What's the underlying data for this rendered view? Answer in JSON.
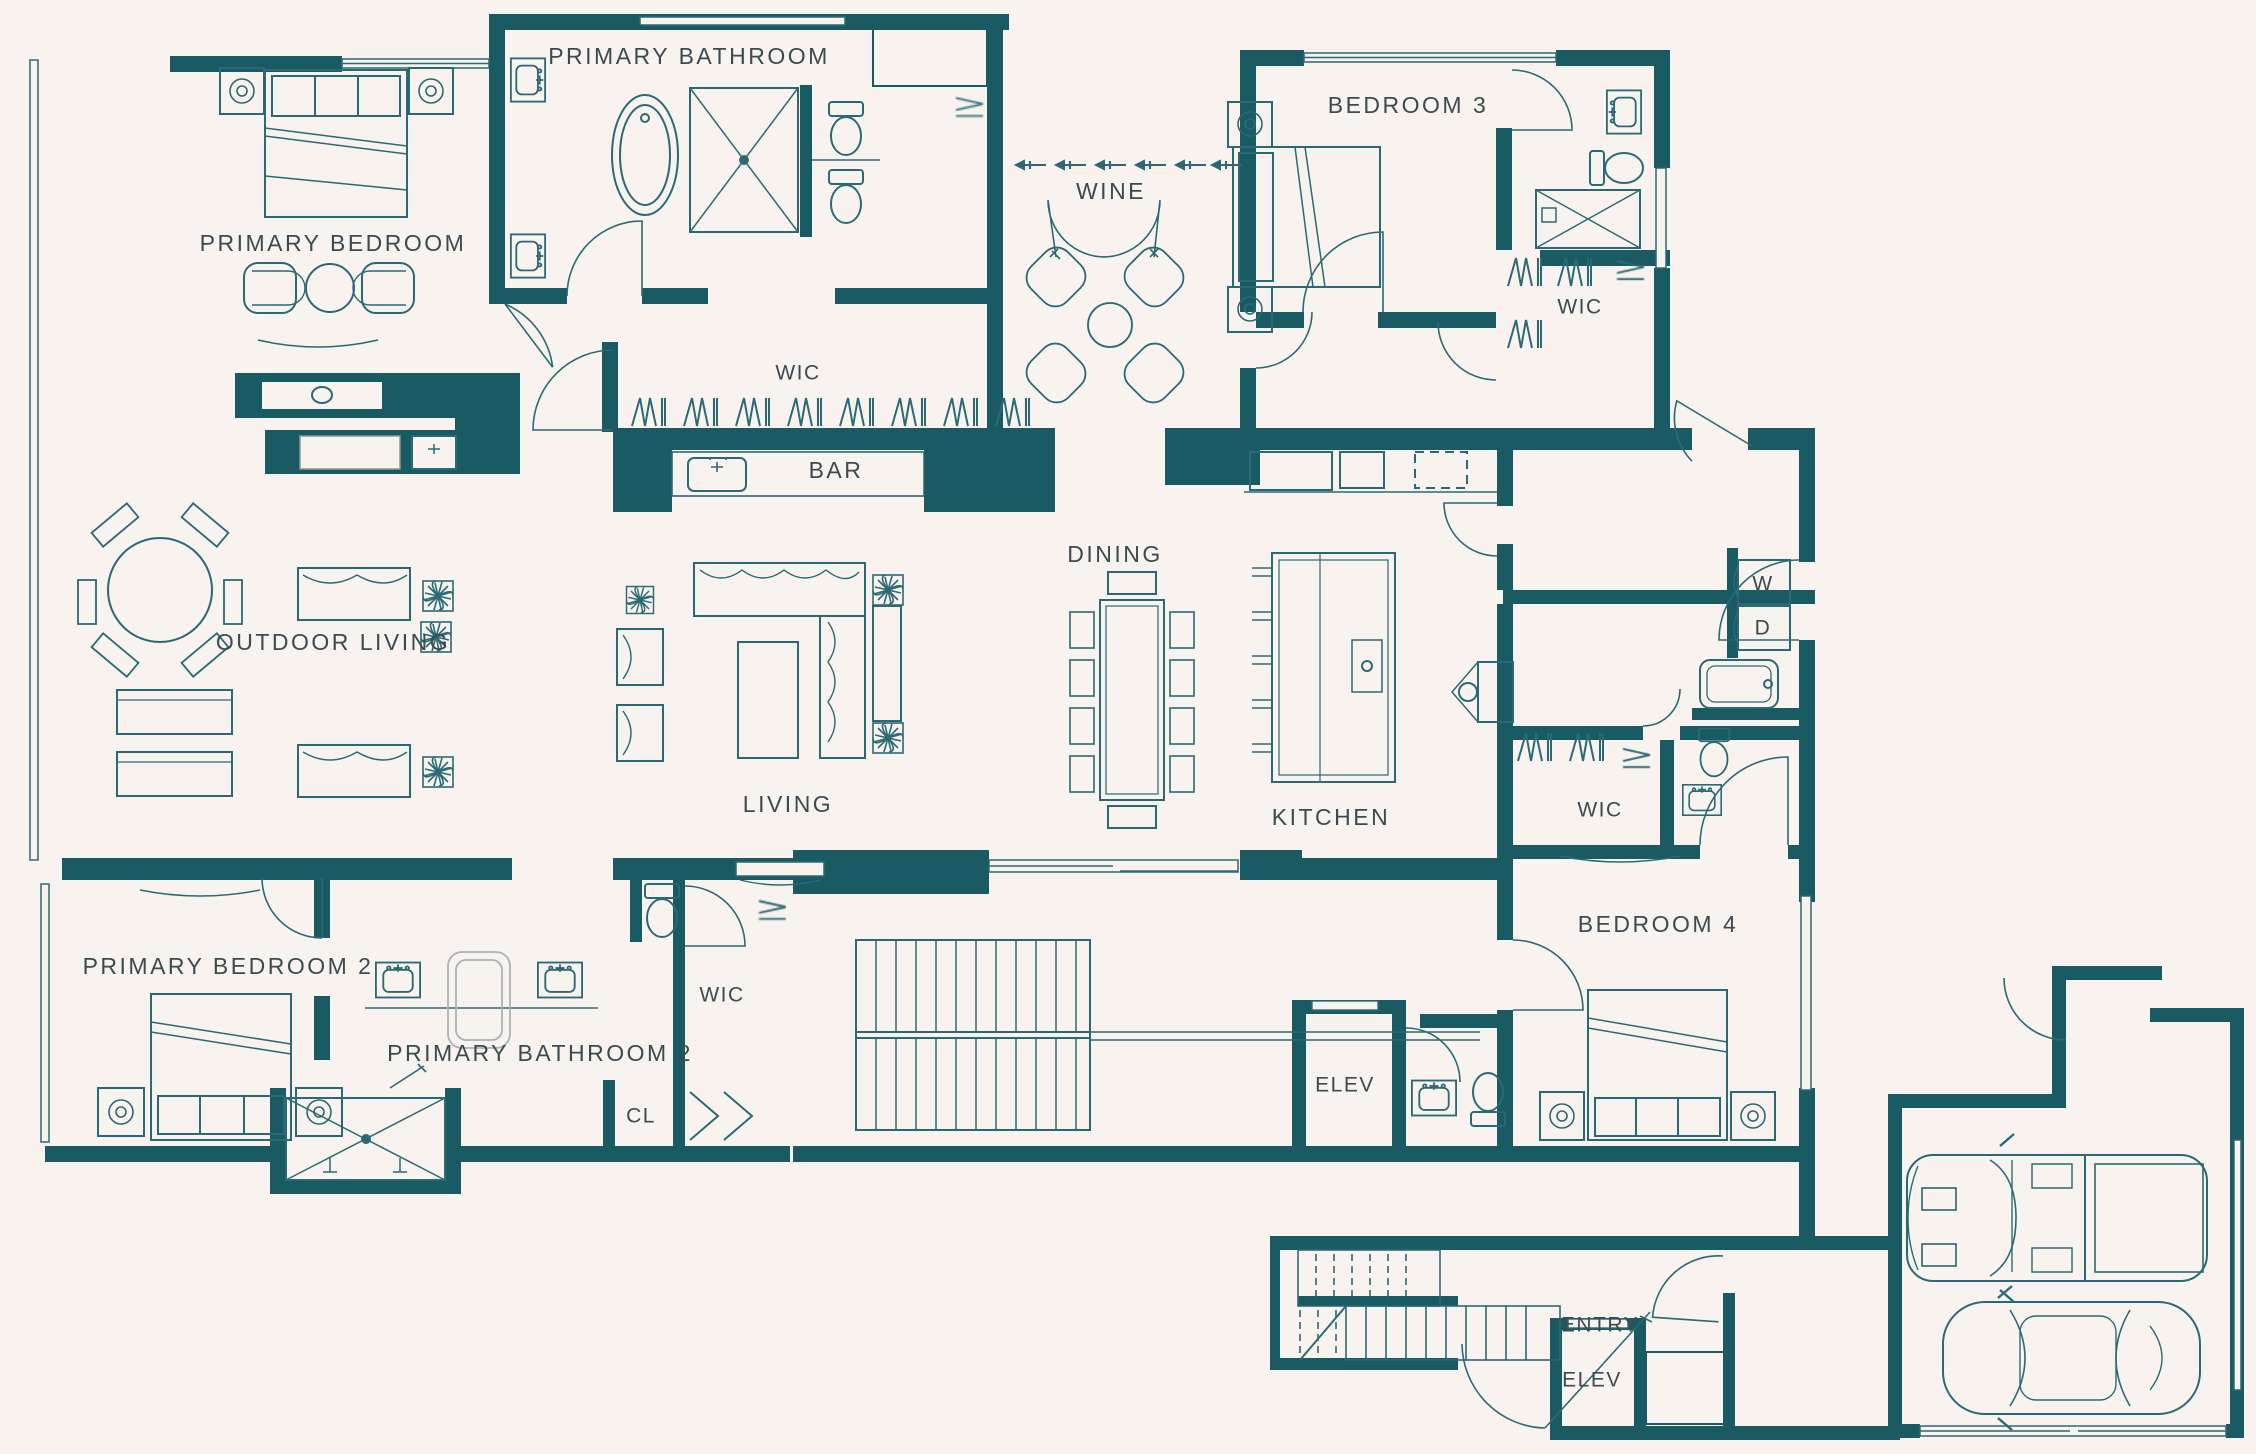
{
  "colors": {
    "wall": "#1a5a63",
    "line": "#2b6a74",
    "background": "#f8f3ee",
    "text": "#3c4b4f",
    "muted": "#a9b4b5"
  },
  "rooms": {
    "primary_bathroom": "PRIMARY BATHROOM",
    "primary_bedroom": "PRIMARY BEDROOM",
    "wine": "WINE",
    "bedroom_3": "BEDROOM 3",
    "wic_bedroom_3": "WIC",
    "wic_primary": "WIC",
    "bar": "BAR",
    "dining": "DINING",
    "outdoor_living": "OUTDOOR LIVING",
    "living": "LIVING",
    "kitchen": "KITCHEN",
    "washer": "W",
    "dryer": "D",
    "wic_bedroom_4": "WIC",
    "bedroom_4": "BEDROOM 4",
    "primary_bedroom_2": "PRIMARY BEDROOM 2",
    "primary_bathroom_2": "PRIMARY BATHROOM 2",
    "wic_primary_2": "WIC",
    "closet": "CL",
    "elevator_main": "ELEV",
    "entry": "ENTRY",
    "elevator_entry": "ELEV"
  }
}
